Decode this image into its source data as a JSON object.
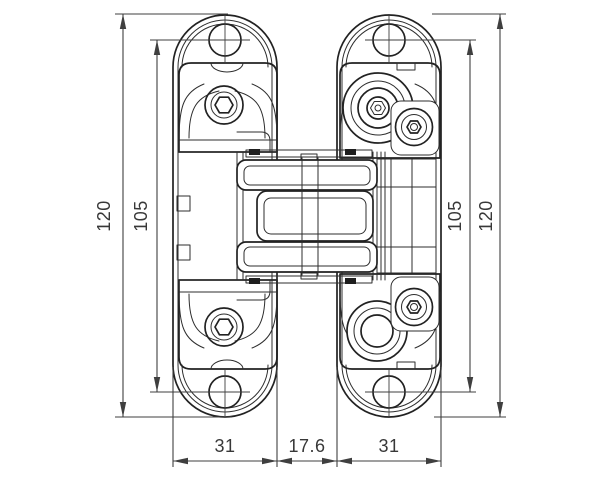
{
  "dimensions": {
    "left_outer": "120",
    "left_inner": "105",
    "right_inner": "105",
    "right_outer": "120",
    "bottom_left_leaf": "31",
    "bottom_center_gap": "17.6",
    "bottom_right_leaf": "31"
  },
  "colors": {
    "background": "#ffffff",
    "part_line": "#222222",
    "dimension_line": "#3f3f3f",
    "dimension_text": "#383838"
  }
}
